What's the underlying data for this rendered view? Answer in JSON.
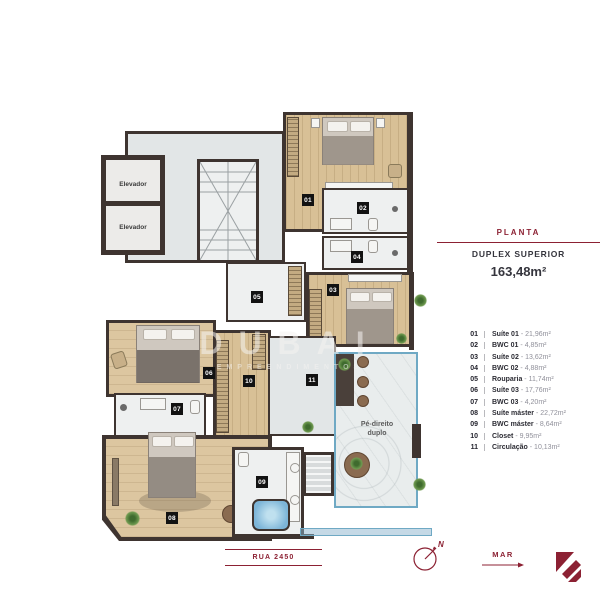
{
  "panel": {
    "title": "PLANTA",
    "subtitle": "DUPLEX SUPERIOR",
    "total_area": "163,48m²"
  },
  "legend": {
    "separator": "-",
    "items": [
      {
        "num": "01",
        "name": "Suíte 01",
        "area": "21,96m²"
      },
      {
        "num": "02",
        "name": "BWC 01",
        "area": "4,85m²"
      },
      {
        "num": "03",
        "name": "Suíte 02",
        "area": "13,62m²"
      },
      {
        "num": "04",
        "name": "BWC 02",
        "area": "4,88m²"
      },
      {
        "num": "05",
        "name": "Rouparia",
        "area": "11,74m²"
      },
      {
        "num": "06",
        "name": "Suíte 03",
        "area": "17,76m²"
      },
      {
        "num": "07",
        "name": "BWC 03",
        "area": "4,20m²"
      },
      {
        "num": "08",
        "name": "Suíte máster",
        "area": "22,72m²"
      },
      {
        "num": "09",
        "name": "BWC máster",
        "area": "8,64m²"
      },
      {
        "num": "10",
        "name": "Closet",
        "area": "9,95m²"
      },
      {
        "num": "11",
        "name": "Circulação",
        "area": "10,13m²"
      }
    ]
  },
  "plan": {
    "elevator_label": "Elevador",
    "double_height_line1": "Pé-direito",
    "double_height_line2": "duplo",
    "watermark_line1": "DUBAI",
    "watermark_line2": "EMPREENDIMENTOS",
    "markers": [
      "01",
      "02",
      "03",
      "04",
      "05",
      "06",
      "07",
      "08",
      "09",
      "10",
      "11"
    ]
  },
  "footer": {
    "street_label": "RUA 2450",
    "sea_label": "MAR",
    "compass_north": "N"
  },
  "colors": {
    "accent_maroon": "#8c2133",
    "wall": "#3e3430",
    "wood_floor": "#d8c096",
    "glass_blue": "#6fa9c4",
    "marker_bg": "#121212"
  }
}
